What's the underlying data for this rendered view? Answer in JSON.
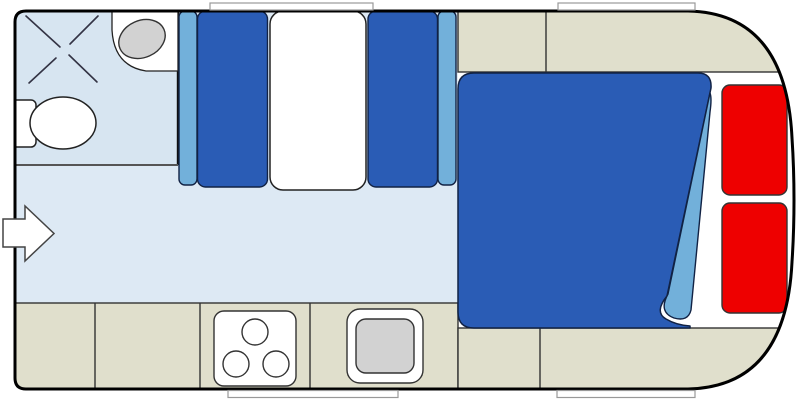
{
  "meta": {
    "title": "Caravan / motorhome floor plan",
    "diagram_type": "floorplan",
    "text_content": "none (no visible text in image)"
  },
  "colors": {
    "wall": "#000000",
    "body_fill": "#ffffff",
    "floor": "#dde9f4",
    "bathroom_floor": "#d7e5f1",
    "upholstery": "#2a5cb5",
    "upholstery_light": "#72b0da",
    "cabinet": "#e0dfcc",
    "fixture_white": "#ffffff",
    "basin_gray": "#d2d2d2",
    "accent_red": "#ee0000",
    "outline": "#222222",
    "window_frame": "#999999"
  },
  "elements": [
    {
      "name": "caravan-body",
      "kind": "vehicle outline, curved right end"
    },
    {
      "name": "entry-door-arrow",
      "kind": "entrance arrow through left wall"
    },
    {
      "name": "shower",
      "kind": "shower tray marked with X"
    },
    {
      "name": "toilet",
      "kind": "toilet with cistern against left wall"
    },
    {
      "name": "washbasin",
      "kind": "corner basin unit, grey bowl"
    },
    {
      "name": "dinette",
      "kind": "two facing bench seats with white table"
    },
    {
      "name": "overhead-cabinet",
      "kind": "beige cabinet run, top right"
    },
    {
      "name": "kitchen-counter",
      "kind": "beige counter run along bottom"
    },
    {
      "name": "stove",
      "kind": "3-burner hob"
    },
    {
      "name": "kitchen-sink",
      "kind": "square sink with grey bowl"
    },
    {
      "name": "double-bed",
      "kind": "blue mattress with turned-down corner"
    },
    {
      "name": "red-lockers",
      "kind": "two red panels beside bed"
    },
    {
      "name": "windows",
      "kind": "4 white window strips in walls"
    }
  ]
}
